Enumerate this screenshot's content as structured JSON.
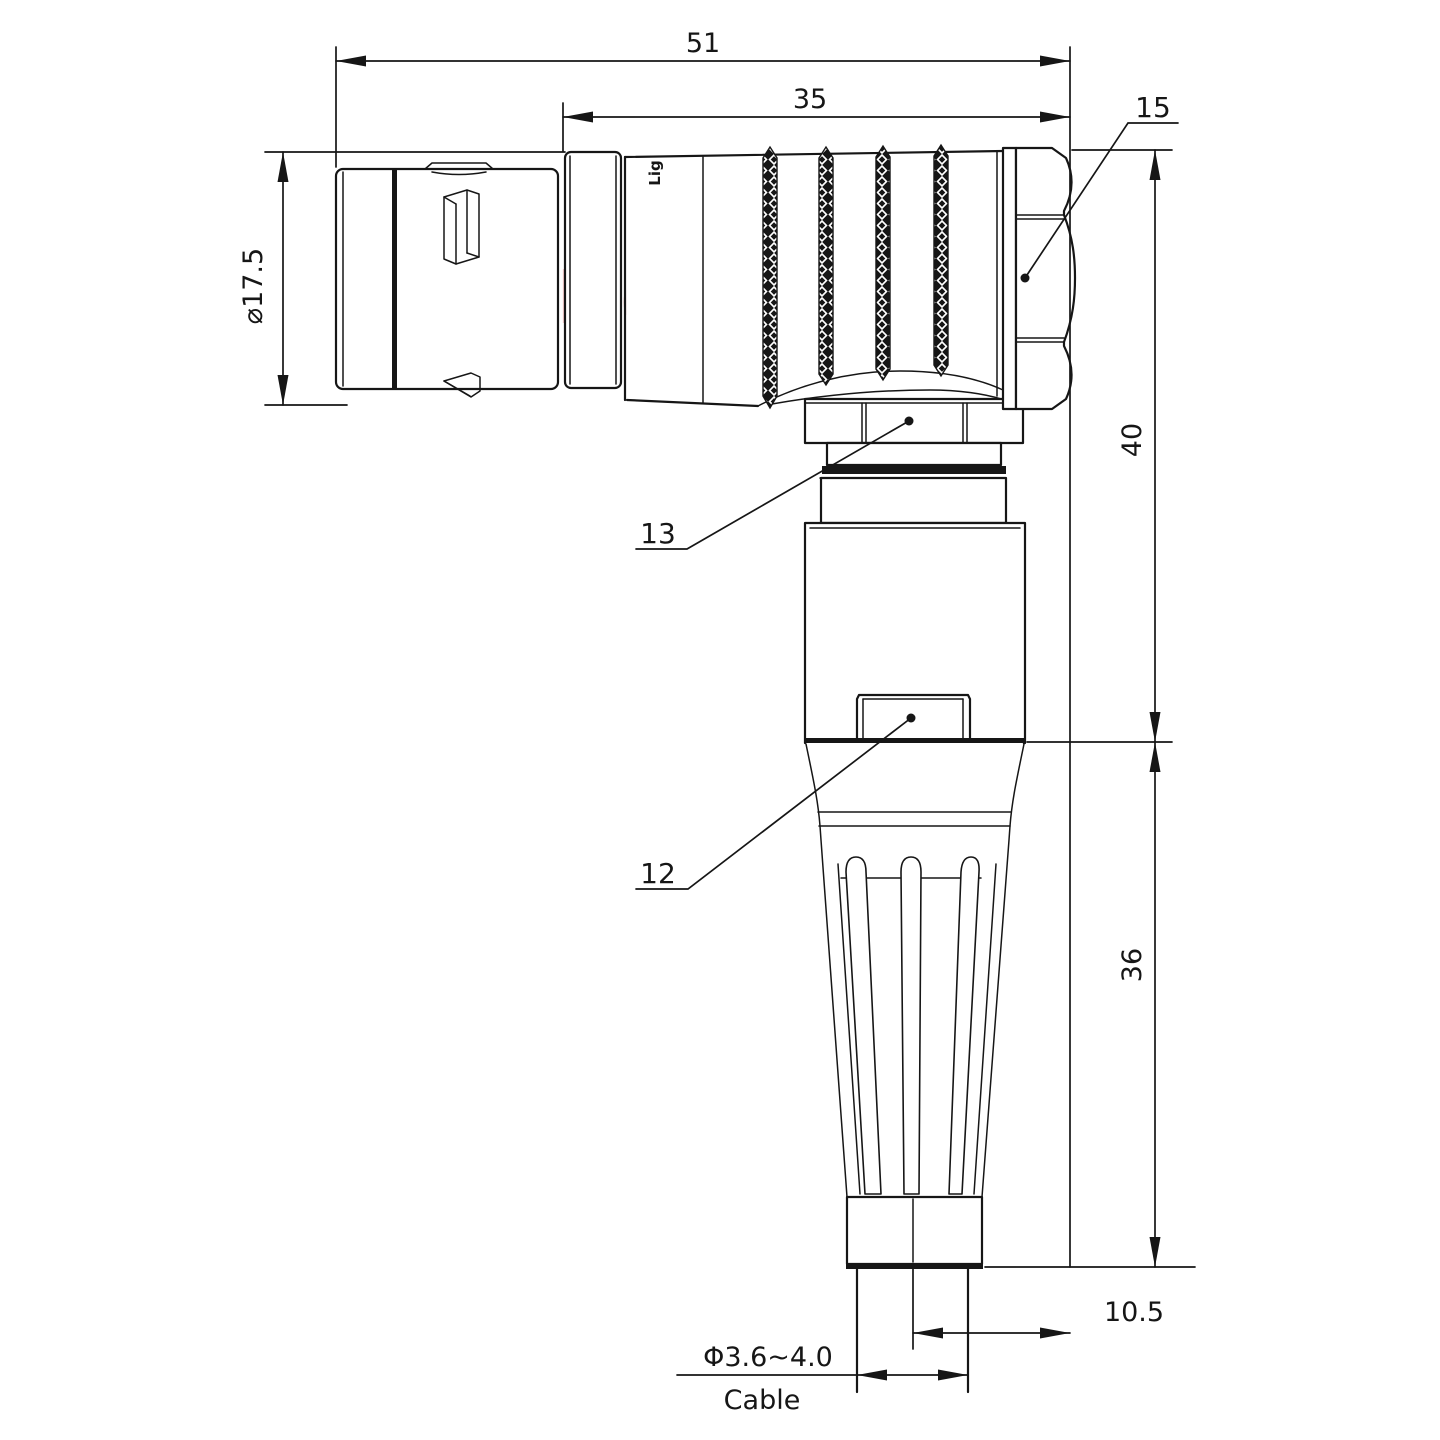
{
  "watermark": "Lightany",
  "part_marking": "Lig",
  "dimensions": {
    "overall_length": "51",
    "rear_length": "35",
    "hex_ref": "15",
    "nut_ref": "13",
    "housing_ref": "12",
    "upper_height": "40",
    "lower_height": "36",
    "cable_center_offset": "10.5",
    "shell_diameter": "⌀17.5",
    "cable_diameter": "Φ3.6~4.0",
    "cable_label": "Cable"
  },
  "colors": {
    "line": "#161616",
    "watermark": "#f2c0c0",
    "background": "#ffffff"
  }
}
